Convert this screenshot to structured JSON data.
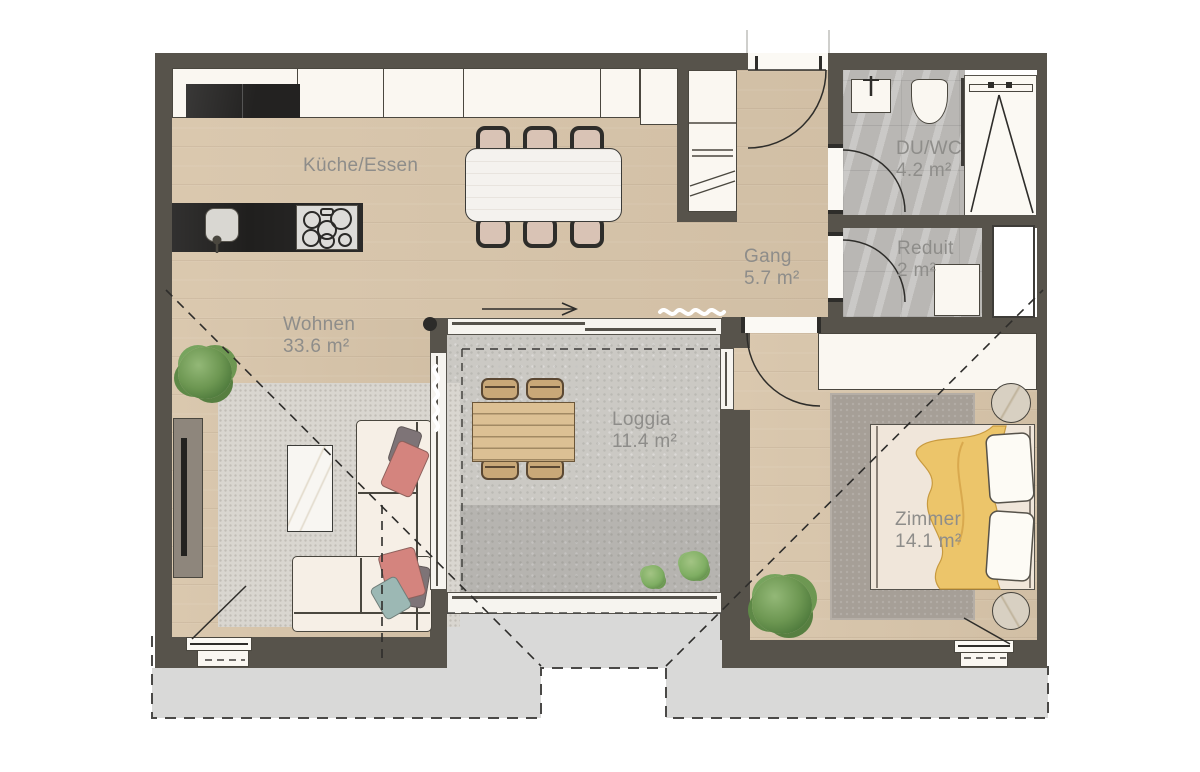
{
  "rooms": [
    {
      "name": "Küche/Essen",
      "area": ""
    },
    {
      "name": "Wohnen",
      "area": "33.6 m²"
    },
    {
      "name": "Gang",
      "area": "5.7 m²"
    },
    {
      "name": "DU/WC",
      "area": "4.2 m²"
    },
    {
      "name": "Reduit",
      "area": "2 m²"
    },
    {
      "name": "Loggia",
      "area": "11.4 m²"
    },
    {
      "name": "Zimmer",
      "area": "14.1 m²"
    }
  ],
  "colors": {
    "wall": "#57534b",
    "wood": "#d8c5aa",
    "concrete": "#cbc9c4",
    "marble": "#b9b7b4",
    "exterior": "#d9d9d8",
    "fixture": "#faf7f1",
    "line": "#3e3c38",
    "label": "#8e8d8a",
    "accent-yellow": "#ecc56a",
    "rug-living": "#d9d6d0",
    "rug-bedroom": "#a69f97",
    "sofa-cream": "#f6efe6",
    "plant-green": "#6d9556",
    "pillow-pink": "#d4847e",
    "pillow-gray": "#7e7477",
    "pillow-teal": "#9cb8b4"
  }
}
